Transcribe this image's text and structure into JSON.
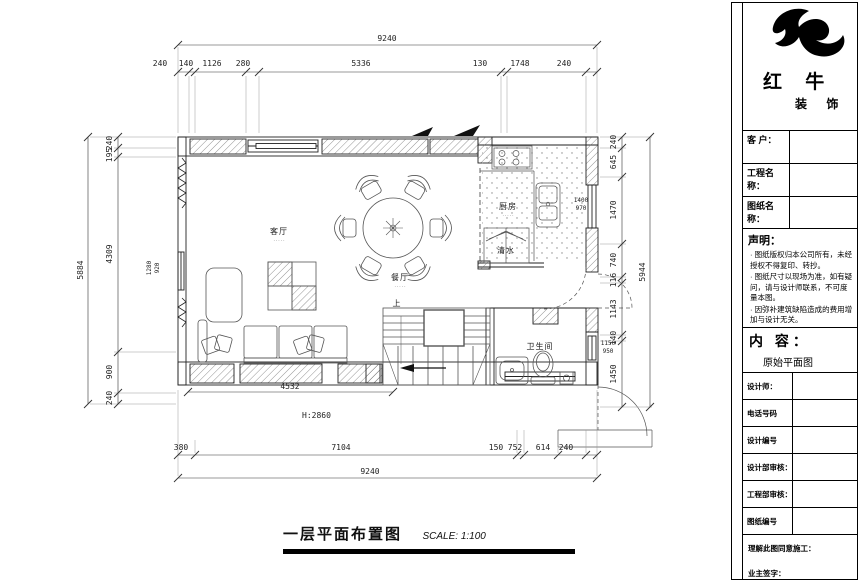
{
  "brand": {
    "name": "红 牛",
    "suffix": "装 饰"
  },
  "title_block": {
    "field_labels": [
      "客 户：",
      "工程名称：",
      "图纸名称："
    ],
    "statement_heading": "声明：",
    "statement_items": [
      "图纸版权归本公司所有，未经授权不得复印、转抄。",
      "图纸尺寸以现场为准，如有疑问，请与设计师联系，不可度量本图。",
      "因弥补建筑缺陷造成的费用增加与设计无关。"
    ],
    "content_heading": "内 容：",
    "content_value": "原始平面图",
    "info_labels": [
      "设计师：",
      "电话号码",
      "设计编号",
      "设计部审核：",
      "工程部审核：",
      "图纸编号"
    ],
    "footer_note": "理解此图同意施工：",
    "signature_label": "业主签字："
  },
  "drawing_footer": {
    "title": "一层平面布置图",
    "scale": "SCALE: 1:100"
  },
  "dims": {
    "top_overall": "9240",
    "top_segs": [
      "240",
      "140",
      "1126",
      "280",
      "5336",
      "130",
      "1748",
      "240"
    ],
    "bottom_overall": "9240",
    "bottom_segs": [
      "380",
      "7104",
      "150",
      "752",
      "614",
      "240"
    ],
    "left_overall": "5884",
    "left_segs": [
      "240",
      "195",
      "4309",
      "900",
      "240"
    ],
    "right_overall": "5944",
    "right_segs": [
      "240",
      "645",
      "1470",
      "740",
      "116",
      "1143",
      "140",
      "1450"
    ],
    "sofa_width": "4532",
    "height_note": "H:2860",
    "left_window": [
      "1280",
      "920"
    ],
    "kitchen_window": [
      "1400",
      "970"
    ],
    "bath_window": [
      "1150",
      "950"
    ]
  },
  "rooms": {
    "living": "客厅",
    "dining": "餐厅",
    "kitchen": "厨房",
    "bath": "卫生间",
    "cabinet": "清水",
    "stairs_up": "上",
    "note_dots": "·····"
  }
}
